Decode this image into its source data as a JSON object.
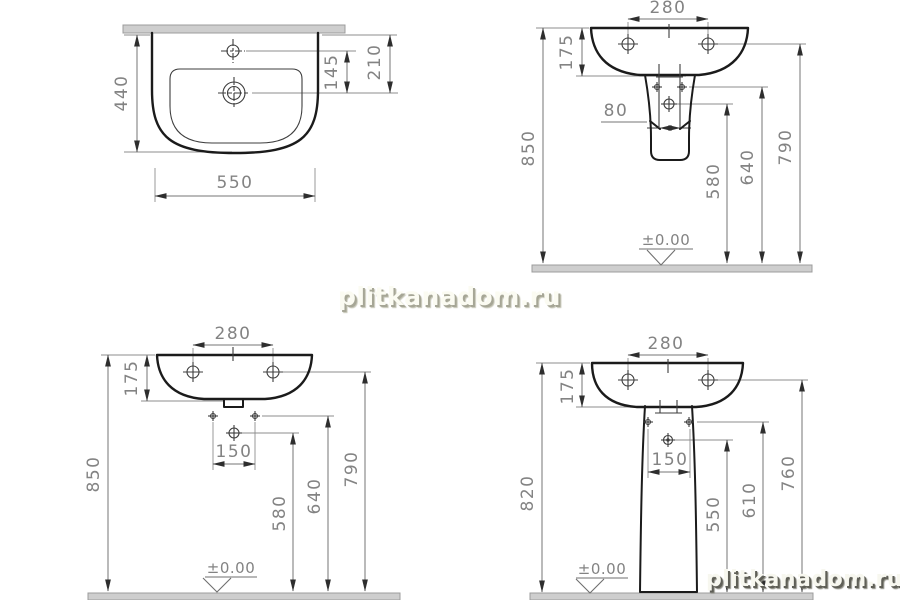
{
  "watermarks": {
    "center": "plitkanadom.ru",
    "corner": "plitkanadom.ru"
  },
  "views": {
    "plan": {
      "depth": "440",
      "width": "550",
      "tap_to_drain": "145",
      "wall_to_drain": "210"
    },
    "side": {
      "hole_spacing": "280",
      "basin_height": "175",
      "outlet_width": "80",
      "overall_height": "850",
      "trap_height": "580",
      "fixing_height": "640",
      "rim_height": "790",
      "floor_level": "±0.00"
    },
    "front": {
      "hole_spacing": "280",
      "basin_height": "175",
      "bolt_spacing": "150",
      "overall_height": "850",
      "trap_height": "580",
      "fixing_height": "640",
      "rim_height": "790",
      "floor_level": "±0.00"
    },
    "pedestal": {
      "hole_spacing": "280",
      "basin_height": "175",
      "bolt_spacing": "150",
      "overall_height": "820",
      "trap_height": "550",
      "fixing_height": "610",
      "rim_height": "760",
      "floor_level": "±0.00"
    }
  }
}
